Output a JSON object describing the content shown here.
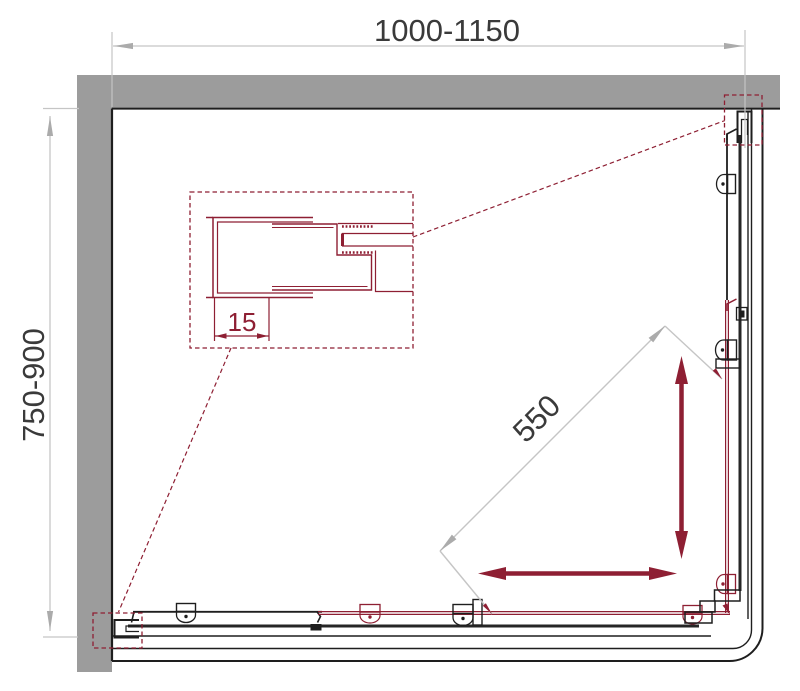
{
  "figure": {
    "name": "corner-shower-enclosure-plan-drawing",
    "dimensions": {
      "width": "1000-1150",
      "depth": "750-900",
      "entry": "550",
      "profile_adjustment": "15"
    },
    "colors": {
      "accent_maroon": "#8E1F33",
      "wall_gray": "#9C9C9C",
      "line_black": "#1E1E1E",
      "glass_dark": "#262626",
      "dimension_gray": "#C5C5C5",
      "dimension_arrow_gray": "#ABABAB",
      "text_dark": "#3A3A3A"
    }
  }
}
